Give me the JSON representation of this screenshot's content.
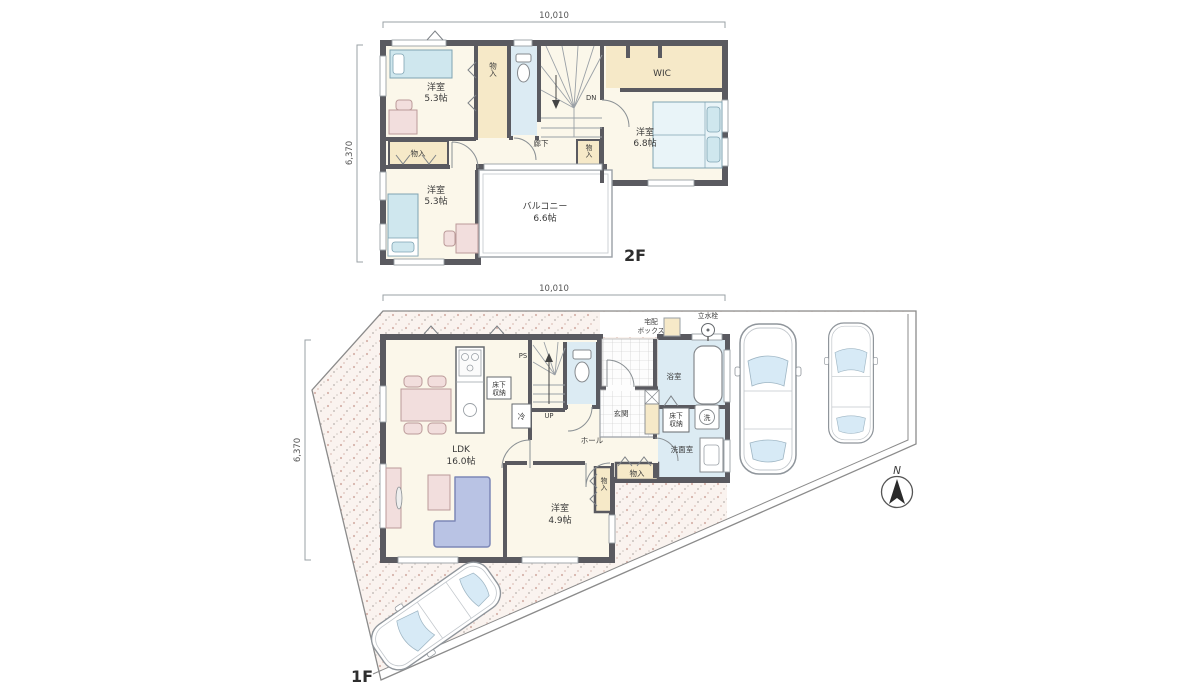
{
  "floor2": {
    "label": "2F",
    "dim_width": "10,010",
    "dim_height": "6,370",
    "bedroom_a_name": "洋室",
    "bedroom_a_size": "5.3帖",
    "bedroom_b_name": "洋室",
    "bedroom_b_size": "5.3帖",
    "bedroom_c_name": "洋室",
    "bedroom_c_size": "6.8帖",
    "wic": "WIC",
    "corridor": "廊下",
    "balcony_name": "バルコニー",
    "balcony_size": "6.6帖",
    "closet": "物入",
    "down": "DN"
  },
  "floor1": {
    "label": "1F",
    "dim_width": "10,010",
    "dim_height": "6,370",
    "ldk_name": "LDK",
    "ldk_size": "16.0帖",
    "bedroom_name": "洋室",
    "bedroom_size": "4.9帖",
    "bath": "浴室",
    "washroom": "洗面室",
    "washer": "洗",
    "fridge": "冷",
    "underfloor_line1": "床下",
    "underfloor_line2": "収納",
    "hall": "ホール",
    "entrance": "玄関",
    "closet": "物入",
    "ps": "PS",
    "up": "UP",
    "delivery_line1": "宅配",
    "delivery_line2": "ボックス",
    "tap": "立水栓"
  },
  "compass": {
    "north": "N"
  },
  "colors": {
    "wall": "#5a5a60",
    "room_floor": "#fbf7ea",
    "closet_tan": "#f6e9c8",
    "wet_area_blue": "#dcebf3",
    "lot_ground": "#faf3ef",
    "furniture_pink": "#f2dedd",
    "sofa_blue": "#b9c3e4",
    "bed_blue": "#cfe7ee"
  }
}
